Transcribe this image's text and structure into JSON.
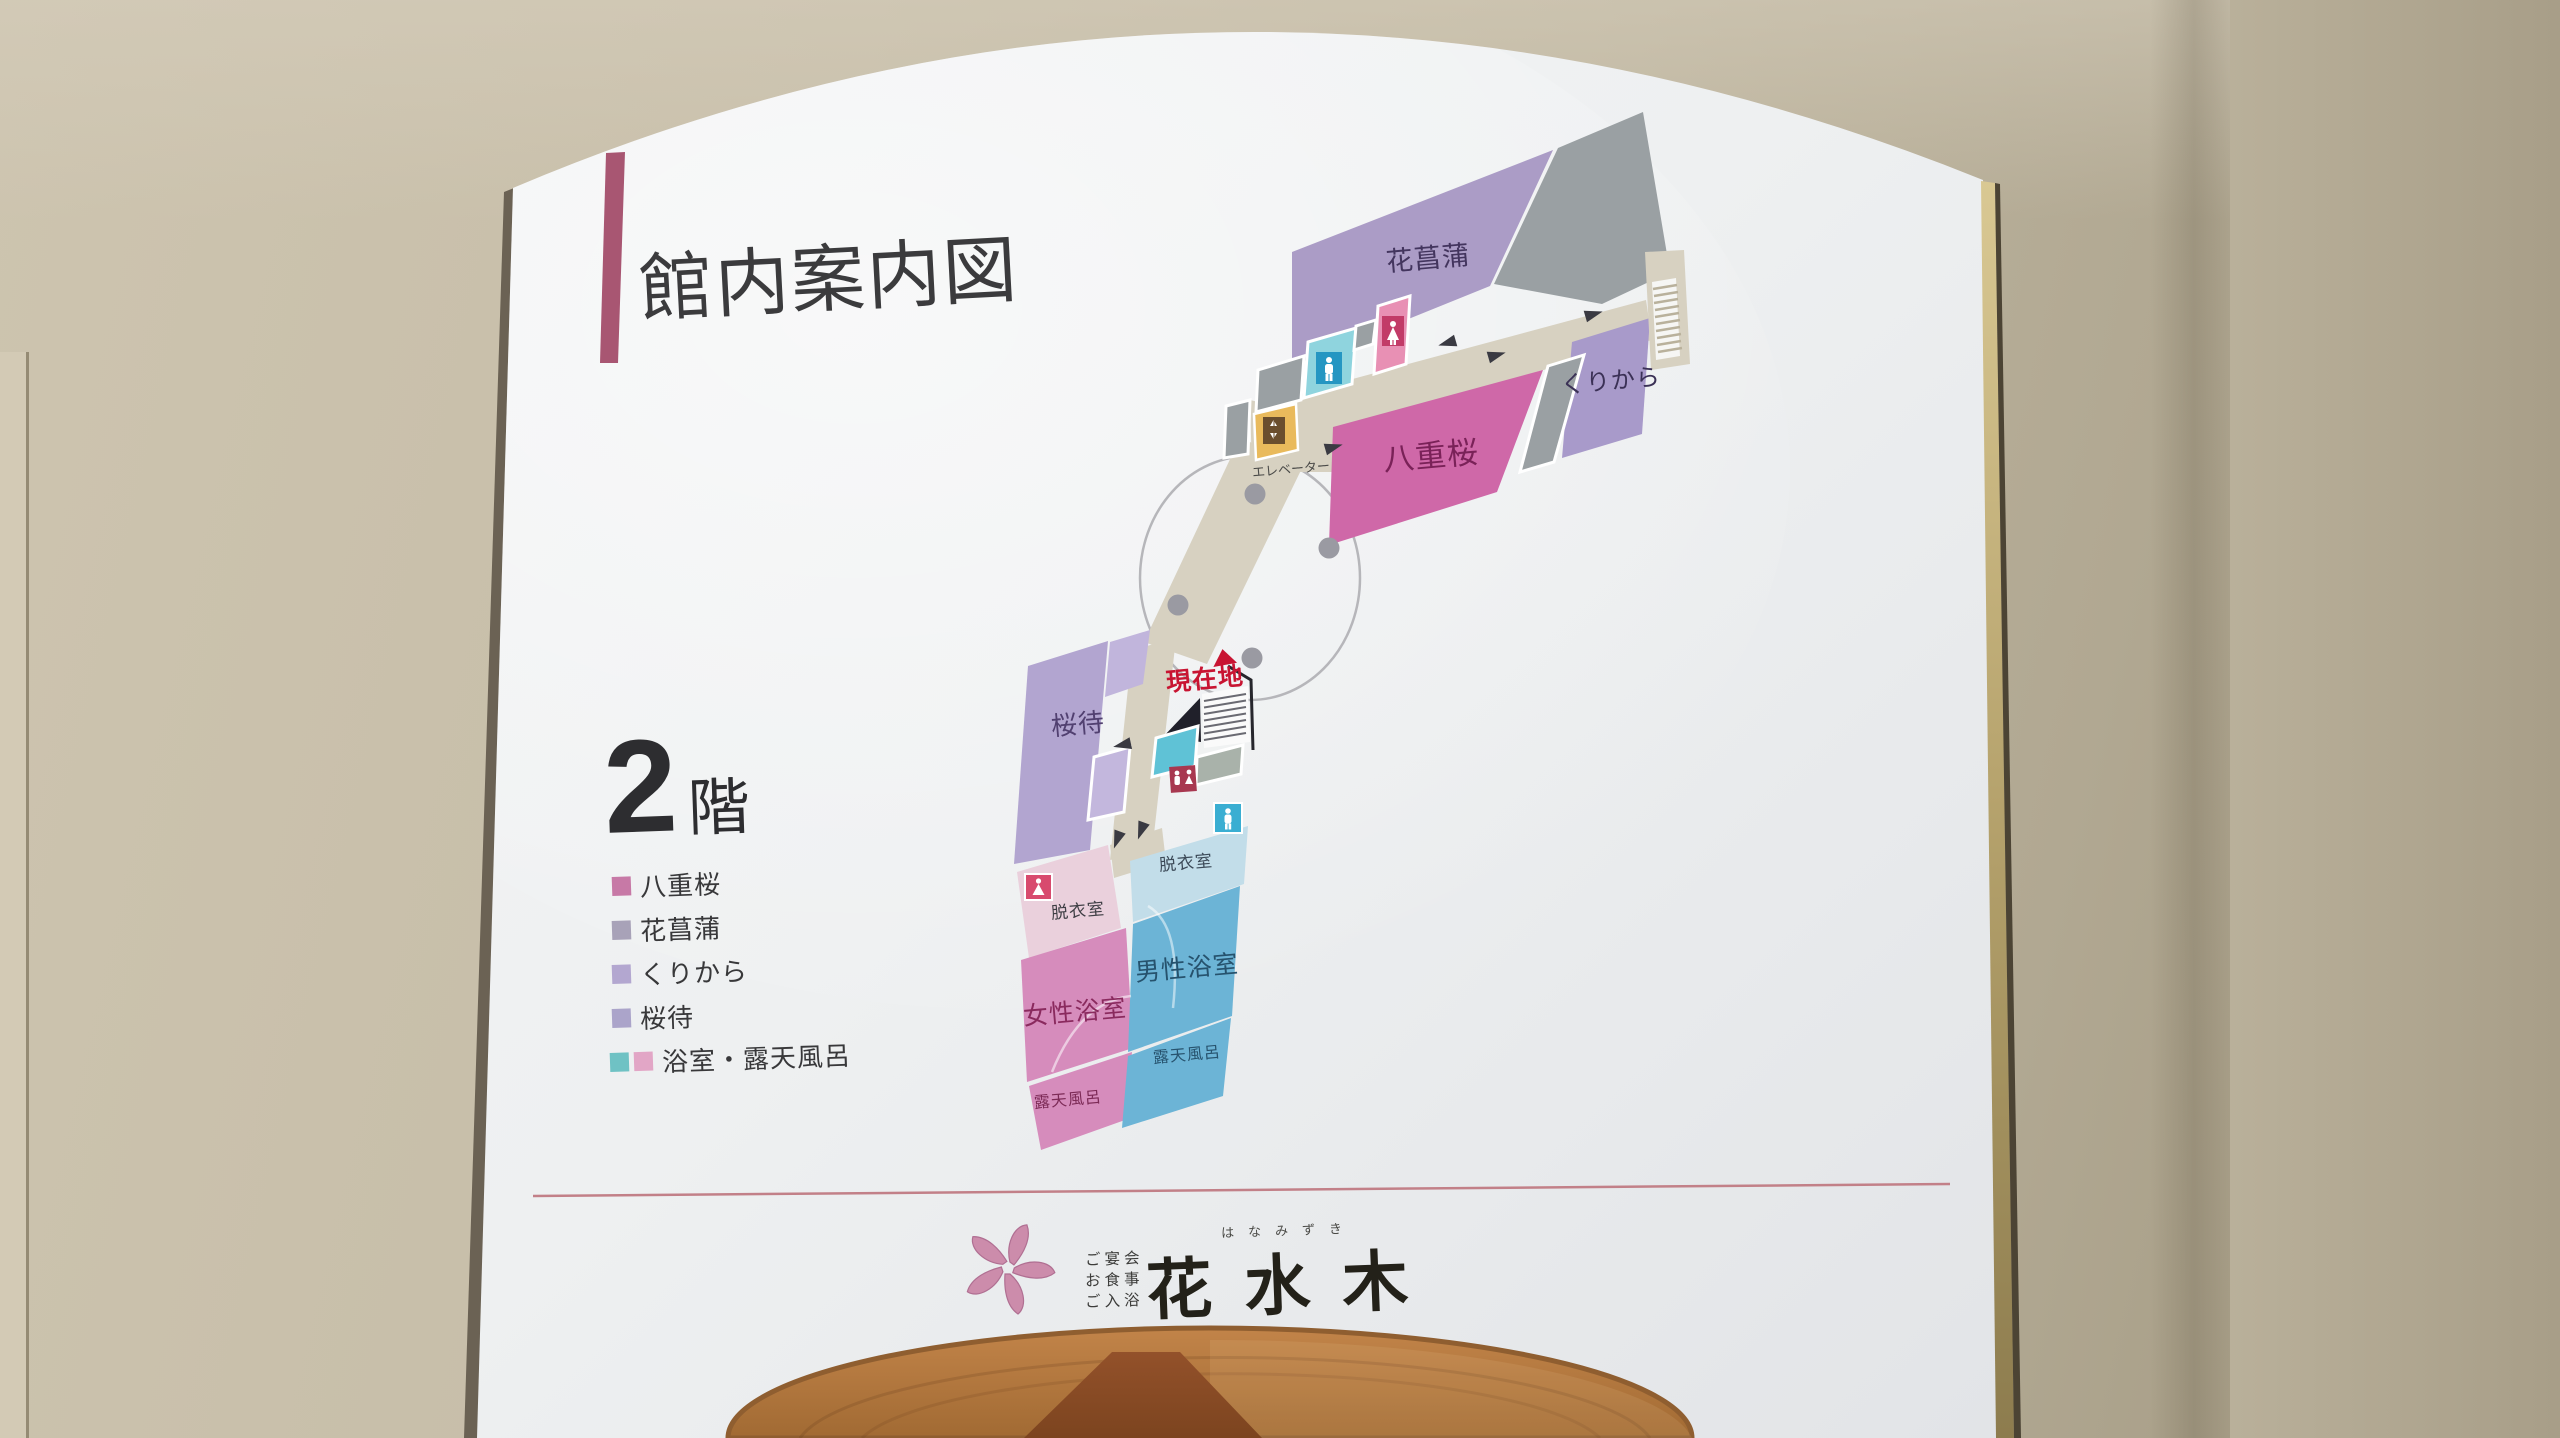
{
  "colors": {
    "accent_bar": "#a85672",
    "divider_line": "#c28088",
    "current_red": "#c81432",
    "room_yaezakura": "#cf68a8",
    "room_hanashoubu": "#ab9cc6",
    "room_kurikara": "#a89aca",
    "room_sakuramachi": "#b2a5d0",
    "room_mens_bath": "#6cb4d6",
    "room_womens_bath": "#d68cbc",
    "corridor": "#d7d1c1",
    "gray_area": "#9aa0a3",
    "legend_yaezakura": "#c779a6",
    "legend_hanashoubu": "#a8a2b8",
    "legend_kurikara": "#b3a7d0",
    "legend_sakuramachi": "#aba4ca",
    "legend_bath_teal": "#6fc2c4",
    "legend_bath_pink": "#e2a6c6",
    "wood": "#b27a42"
  },
  "title": "館内案内図",
  "floor": {
    "number": "2",
    "suffix": "階"
  },
  "legend": [
    {
      "label": "八重桜"
    },
    {
      "label": "花菖蒲"
    },
    {
      "label": "くりから"
    },
    {
      "label": "桜待"
    },
    {
      "label": "浴室・露天風呂"
    }
  ],
  "map": {
    "rooms": {
      "hanashoubu": "花菖蒲",
      "kurikara": "くりから",
      "yaezakura": "八重桜",
      "sakuramachi": "桜待",
      "mens_bath": "男性浴室",
      "womens_bath": "女性浴室",
      "dressing_room_mens": "脱衣室",
      "dressing_room_womens": "脱衣室",
      "openair_bath_mens": "露天風呂",
      "openair_bath_womens": "露天風呂"
    },
    "elevator_label": "エレベーター",
    "current_location": "現在地"
  },
  "footer": {
    "services": [
      "ご宴会",
      "お食事",
      "ご入浴"
    ],
    "furigana": "はなみずき",
    "brand": "花水木"
  }
}
